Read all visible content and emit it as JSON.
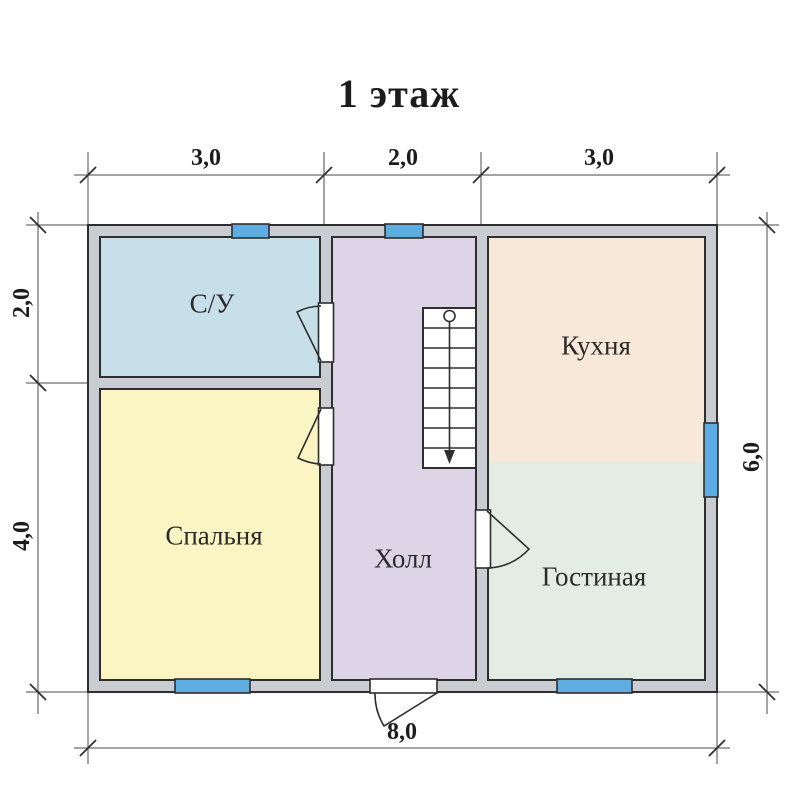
{
  "title": "1 этаж",
  "rooms": [
    {
      "label": "С/У",
      "color": "#c7dfe9"
    },
    {
      "label": "Спальня",
      "color": "#fbf5c3"
    },
    {
      "label": "Холл",
      "color": "#ddd5e7"
    },
    {
      "label": "Кухня",
      "color": "#f8e8d9"
    },
    {
      "label": "Гостиная",
      "color": "#e4ede4"
    }
  ],
  "dimensions": {
    "top": [
      "3,0",
      "2,0",
      "3,0"
    ],
    "left": [
      "2,0",
      "4,0"
    ],
    "right": [
      "6,0"
    ],
    "bottom": [
      "8,0"
    ]
  },
  "colors": {
    "wall": "#c9cdd2",
    "outline": "#2e2e2e",
    "window": "#5fade0",
    "stairs": "#ffffff",
    "text": "#1c1c1c",
    "background": "#ffffff"
  }
}
